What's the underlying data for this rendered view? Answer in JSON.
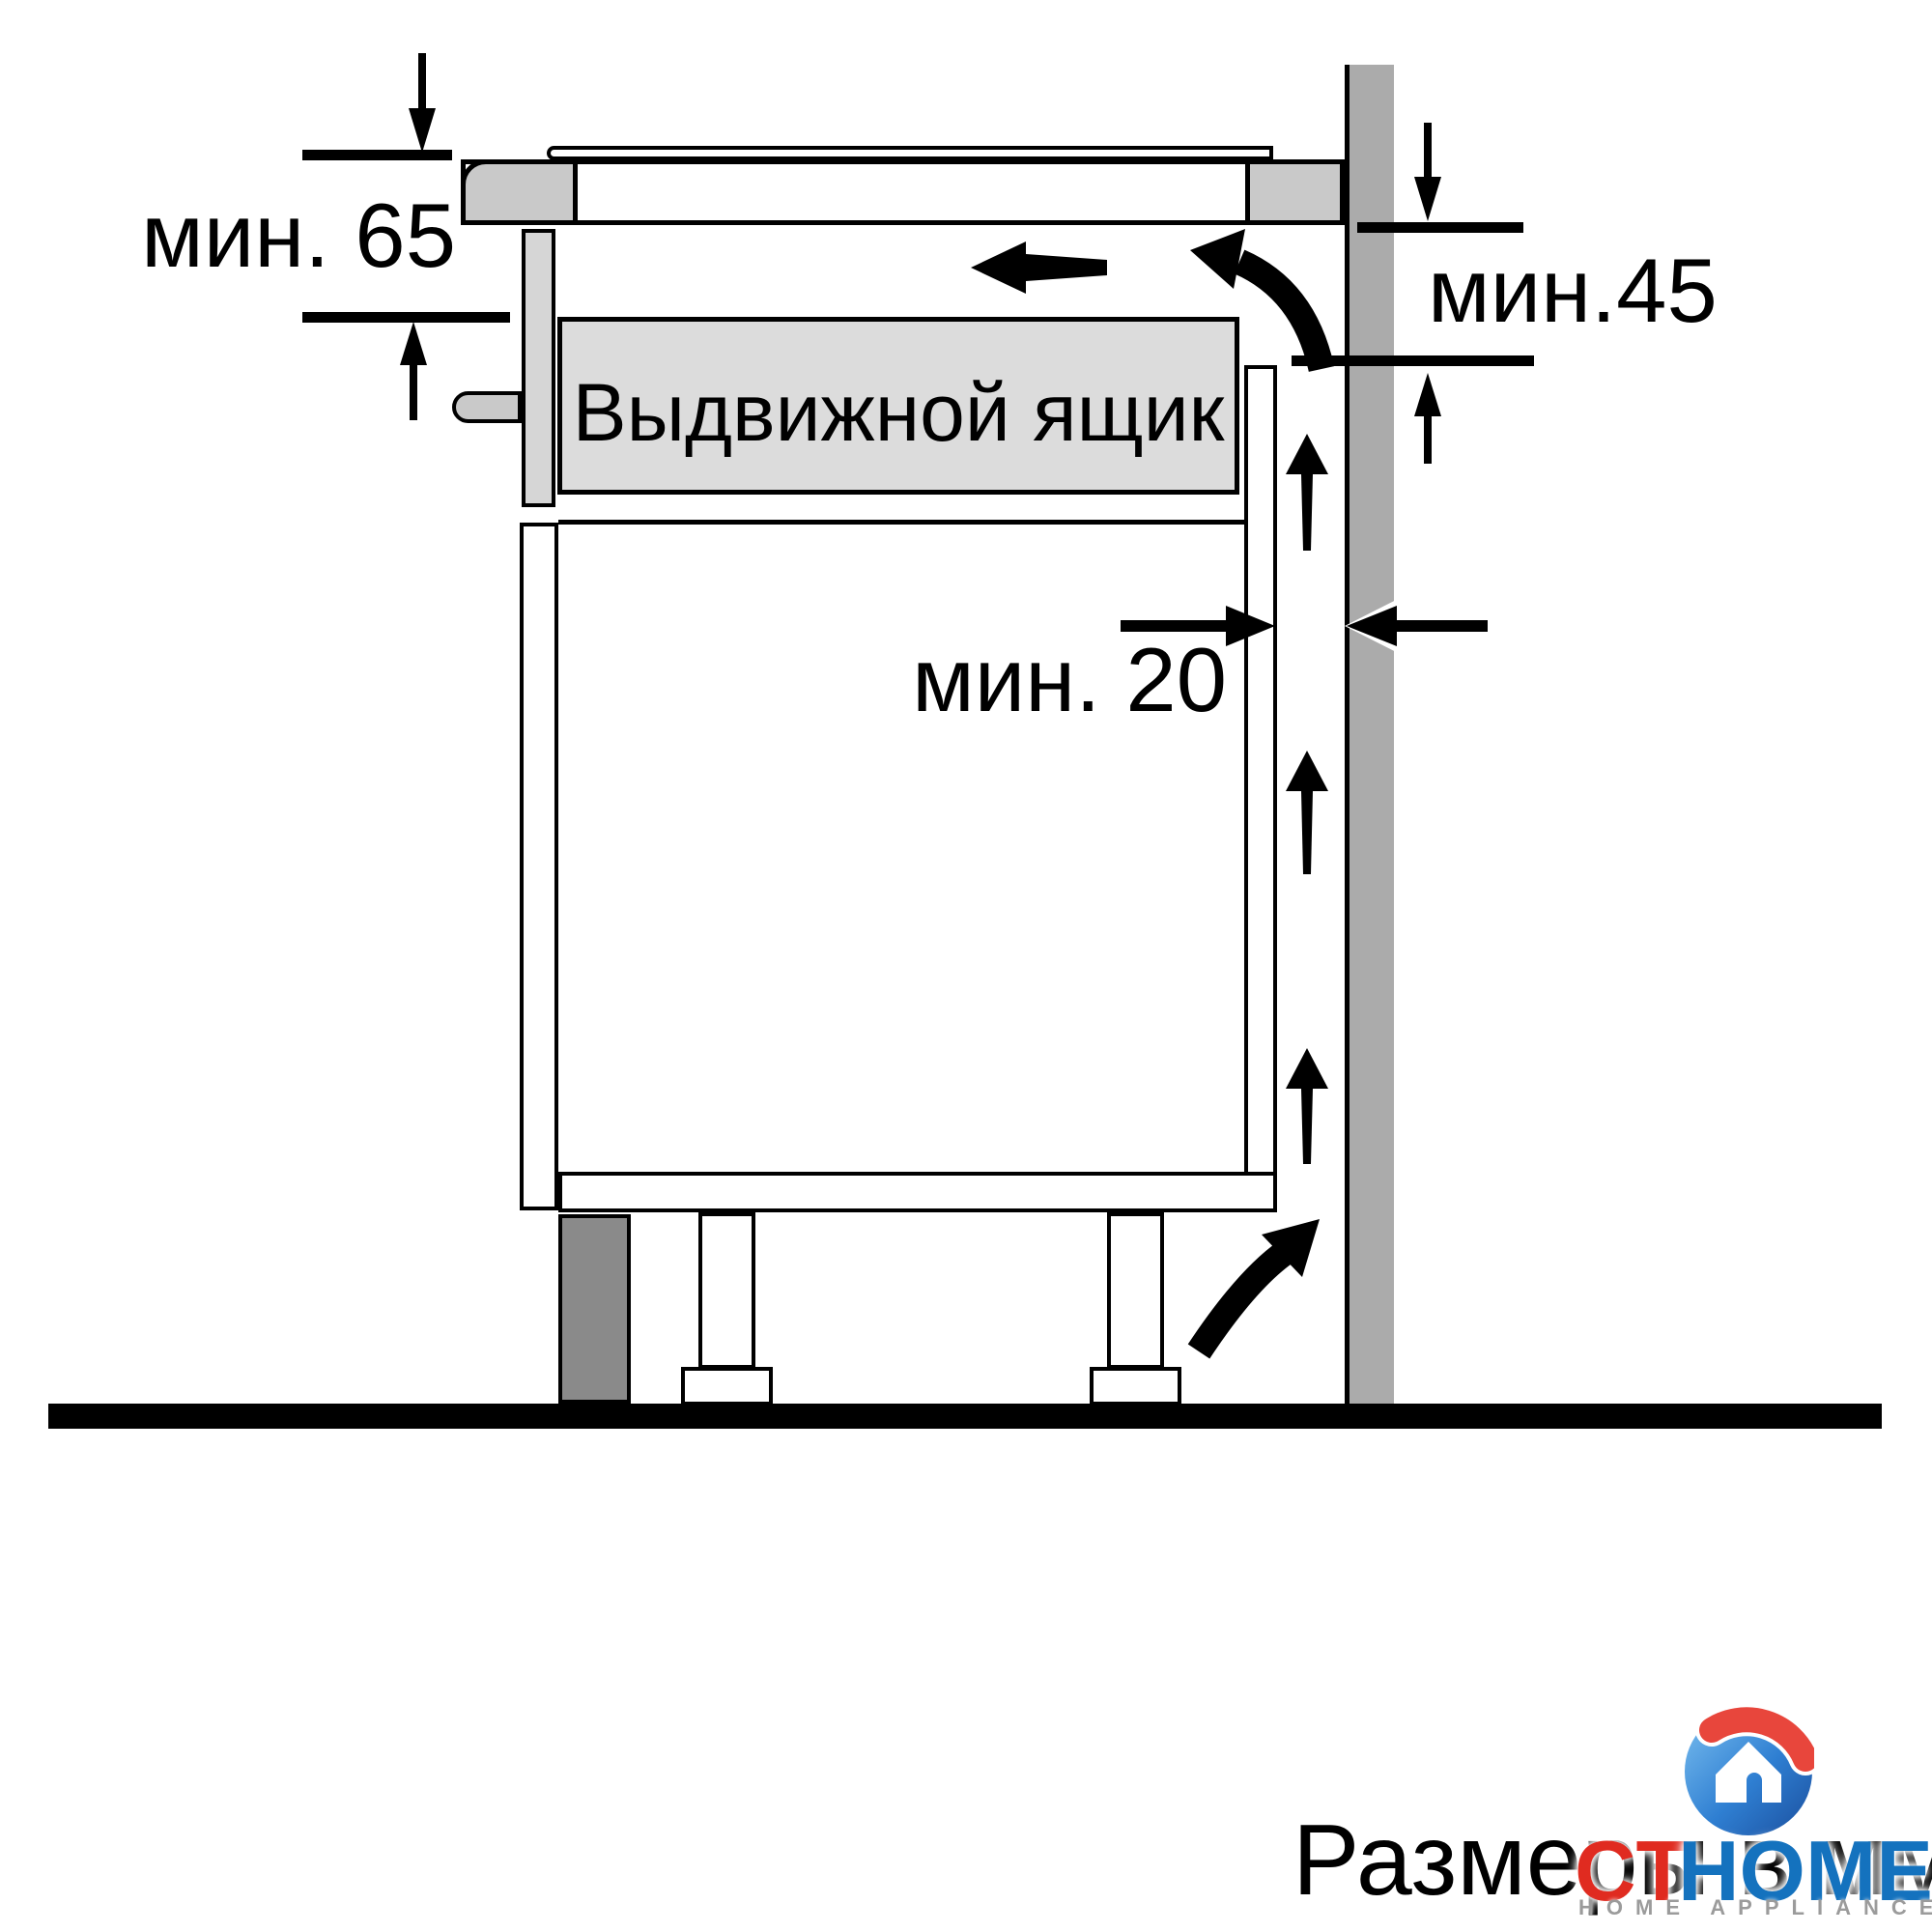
{
  "diagram": {
    "dimension_labels": {
      "top_left": "мин. 65",
      "right": "мин.45",
      "rear_gap": "мин. 20"
    },
    "drawer_label": "Выдвижной ящик",
    "footer_caption": "Размеры в мм"
  },
  "logo": {
    "icon": "house-logo-icon",
    "brand_primary": "CT",
    "brand_secondary": "HOME",
    "tagline": "HOME APPLIANCES"
  },
  "colors": {
    "wall": "#ababab",
    "plinth": "#8a8a8a",
    "counter_section": "#c9c9c9",
    "drawer_fill": "#dcdcdc",
    "drawer_front": "#d6d6d6",
    "line": "#000000",
    "logo_red": "#e02b20",
    "logo_blue": "#1472be",
    "tagline_gray": "#9b9b9b"
  }
}
